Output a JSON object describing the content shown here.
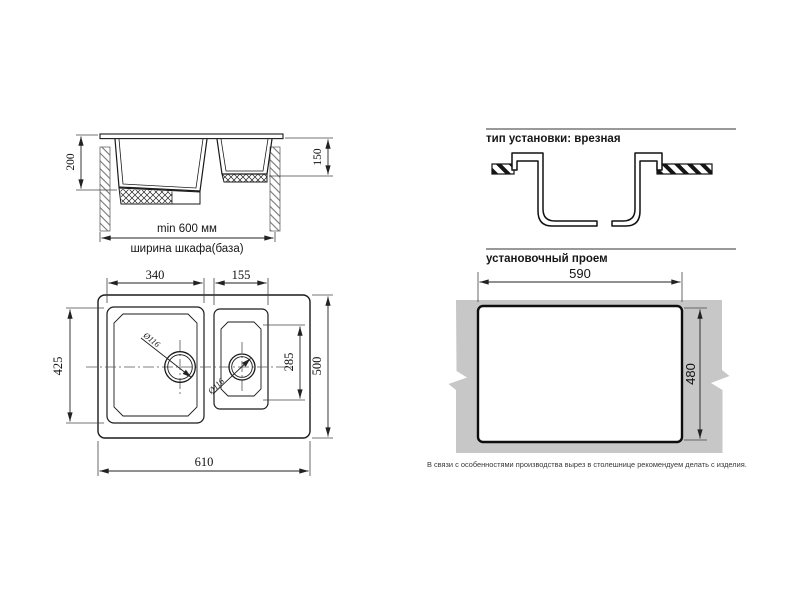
{
  "section_view": {
    "dim_bowl_depth_main": "200",
    "dim_bowl_depth_small": "150",
    "dim_cabinet_min_width": "min 600 мм",
    "cabinet_width_label": "ширина шкафа(база)"
  },
  "top_view": {
    "dim_main_bowl_width": "340",
    "dim_small_bowl_width": "155",
    "dim_main_bowl_length": "425",
    "dim_small_bowl_length": "285",
    "dim_overall_length": "500",
    "dim_overall_width": "610",
    "dim_main_drain_diameter": "Ø116",
    "dim_small_drain_diameter": "Ø116"
  },
  "installation": {
    "type_heading": "тип установки: врезная",
    "cutout_heading": "установочный проем",
    "dim_cutout_width": "590",
    "dim_cutout_height": "480",
    "note": "В связи с особенностями производства вырез в столешнице рекомендуем делать с изделия."
  },
  "colors": {
    "line": "#1a1a1a",
    "countertop": "#c7c7c7"
  }
}
